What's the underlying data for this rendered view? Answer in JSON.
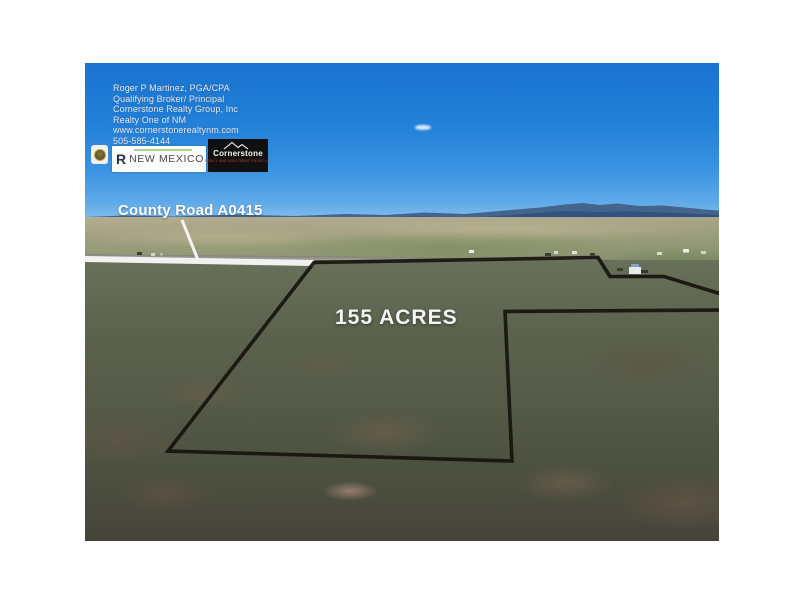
{
  "photo": {
    "contact": {
      "lines": [
        "Roger P Martinez, PGA/CPA",
        "Qualifying Broker/ Principal",
        "Cornerstone Realty Group, Inc",
        "Realty One of NM",
        "www.cornerstonerealtynm.com",
        "505-585-4144"
      ]
    },
    "logos": {
      "realty_one": {
        "mark": "R",
        "name": "NEW MEXICO"
      },
      "cornerstone": {
        "name": "Cornerstone",
        "tagline": "REALTY AND INVESTMENT GROUP LLC"
      },
      "seal_icon": "award-seal-icon"
    },
    "annotations": {
      "road_label": "County Road A0415",
      "acreage_label": "155 ACRES"
    },
    "colors": {
      "sky_top": "#1a73d0",
      "sky_horizon": "#85bfec",
      "mountains": "#3a5a84",
      "boundary_line": "#17130e",
      "road_highlight": "#f1f2ef",
      "label_text": "#ffffff",
      "cornerstone_bg": "#101010",
      "cornerstone_tagline": "#d23b2f",
      "realty_one_green": "#6aa943"
    }
  }
}
